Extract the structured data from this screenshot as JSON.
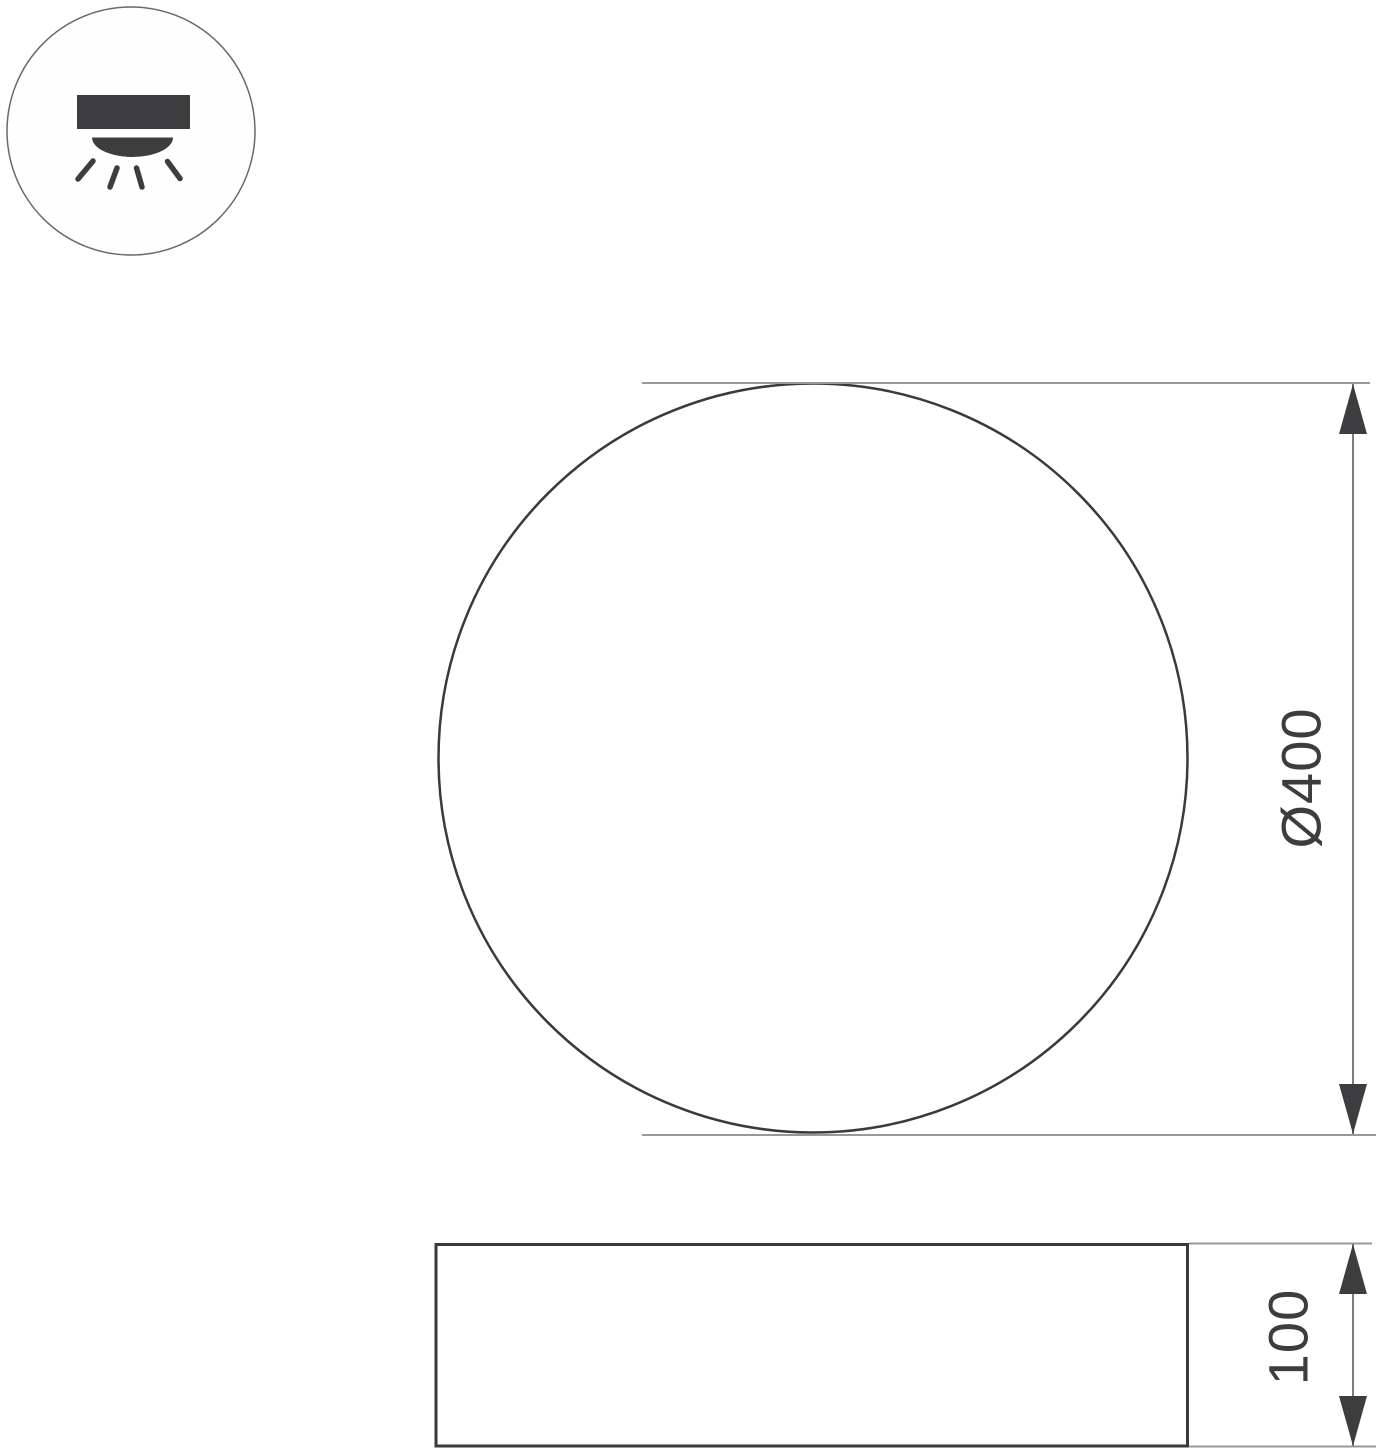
{
  "colors": {
    "bg": "#ffffff",
    "ink": "#3d3d3f",
    "outline": "#3a3a3c",
    "dimline": "#7d7d80",
    "extline": "#98989a",
    "icon_ring": "#69696b"
  },
  "mount_icon": {
    "meaning": "surface-mounted-ceiling-light"
  },
  "plan_view": {
    "diameter_mm": 400,
    "diameter_label": "Ø400"
  },
  "side_view": {
    "height_mm": 100,
    "height_label": "100"
  }
}
